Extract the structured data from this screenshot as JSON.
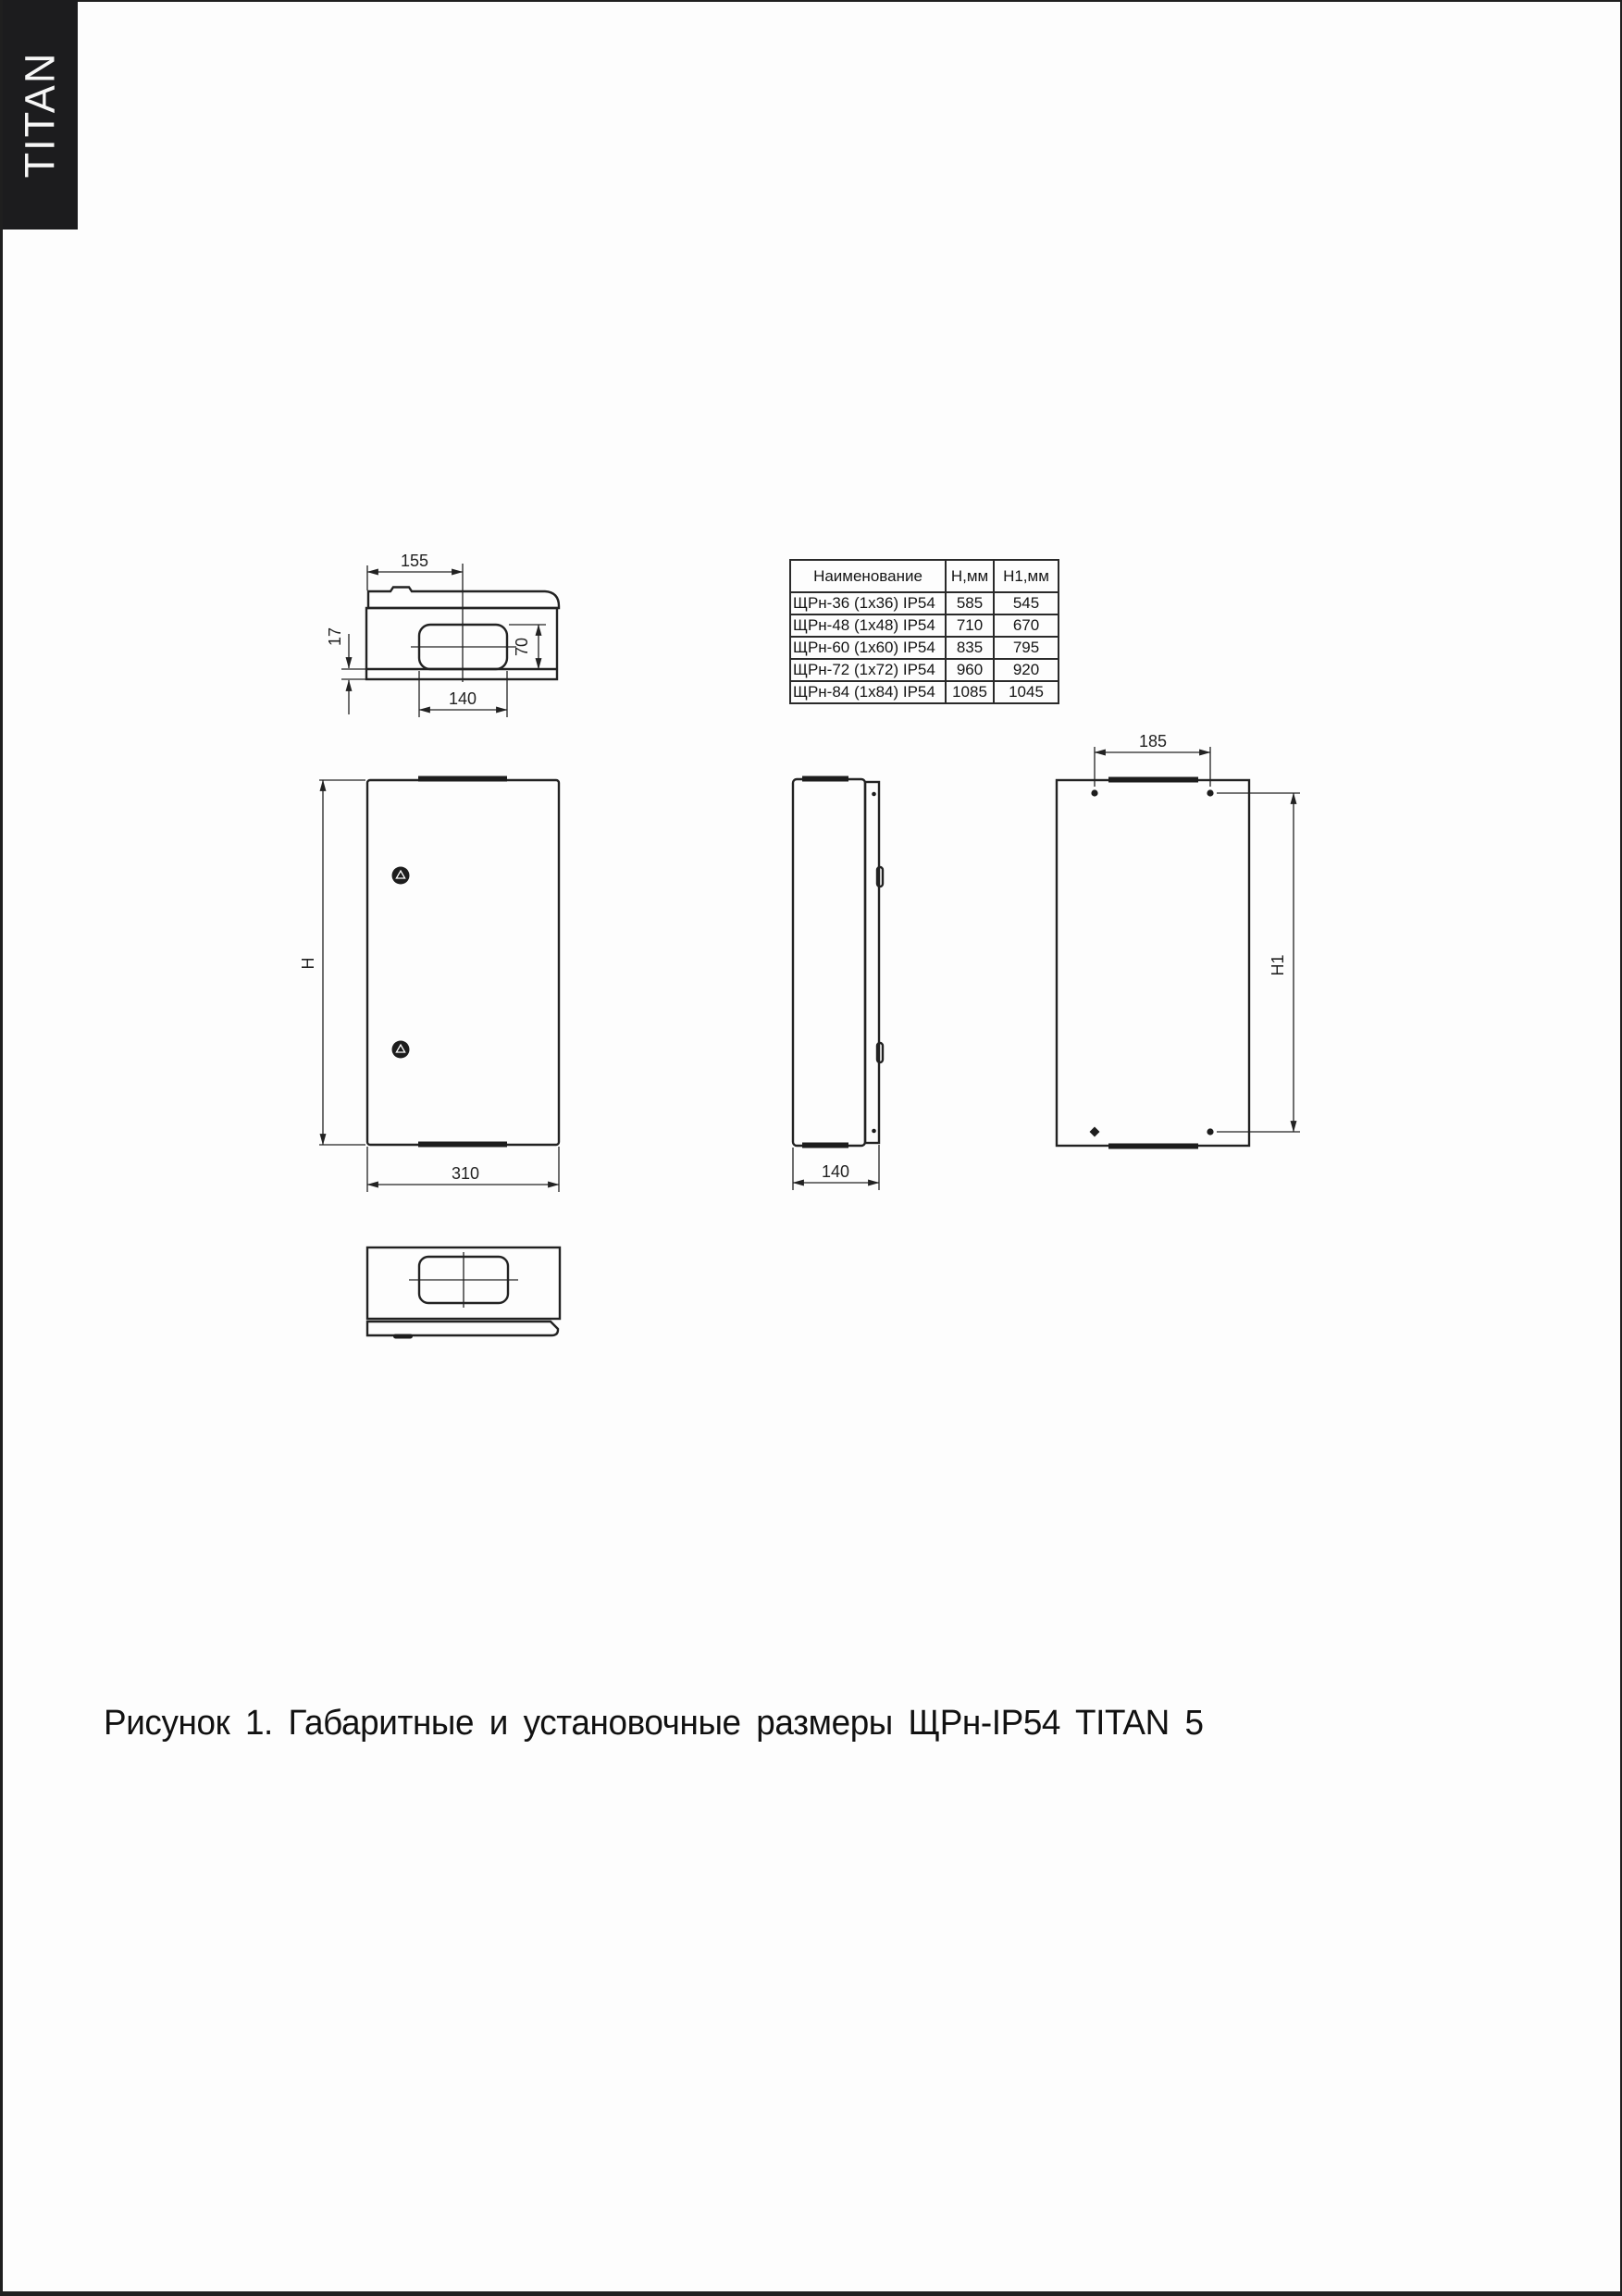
{
  "brand": "TITAN",
  "table": {
    "headers": [
      "Наименование",
      "Н,мм",
      "Н1,мм"
    ],
    "rows": [
      [
        "ЩРн-36 (1x36) IP54",
        "585",
        "545"
      ],
      [
        "ЩРн-48 (1x48) IP54",
        "710",
        "670"
      ],
      [
        "ЩРн-60 (1x60) IP54",
        "835",
        "795"
      ],
      [
        "ЩРн-72 (1x72) IP54",
        "960",
        "920"
      ],
      [
        "ЩРн-84 (1x84) IP54",
        "1085",
        "1045"
      ]
    ]
  },
  "drawings": {
    "top_view": {
      "half_width": "155",
      "depth_offset": "17",
      "cutout_depth": "70",
      "cutout_width": "140"
    },
    "front_view": {
      "height": "H",
      "width": "310"
    },
    "side_view": {
      "depth": "140"
    },
    "rear_view": {
      "mount_width": "185",
      "mount_height": "H1"
    }
  },
  "caption": "Рисунок 1. Габаритные и установочные размеры ЩРн-IP54 TITAN 5",
  "colors": {
    "ink": "#222222",
    "paper": "#fdfdfd",
    "banner": "#1c1c1e"
  }
}
